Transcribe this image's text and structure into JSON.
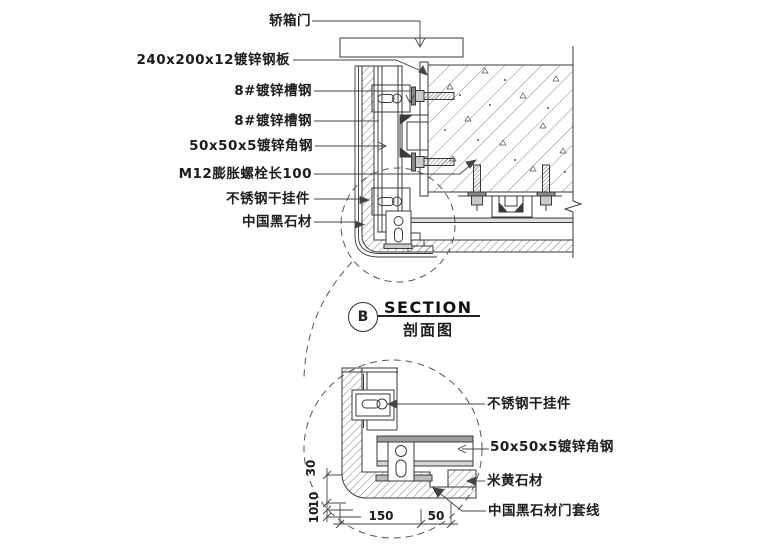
{
  "drawing_type": "architectural-section-detail",
  "section": {
    "bubble": "B",
    "title": "SECTION",
    "subtitle": "剖面图"
  },
  "labels_left": [
    "轿箱门",
    "240x200x12镀锌钢板",
    "8#镀锌槽钢",
    "8#镀锌槽钢",
    "50x50x5镀锌角钢",
    "M12膨胀螺栓长100",
    "不锈钢干挂件",
    "中国黑石材"
  ],
  "labels_right": [
    "不锈钢干挂件",
    "50x50x5镀锌角钢",
    "米黄石材",
    "中国黑石材门套线"
  ],
  "dimensions": {
    "horizontal": [
      "150",
      "50"
    ],
    "vertical": [
      "10",
      "10",
      "30"
    ]
  },
  "colors": {
    "line": "#3a3a3a",
    "background": "#ffffff"
  }
}
